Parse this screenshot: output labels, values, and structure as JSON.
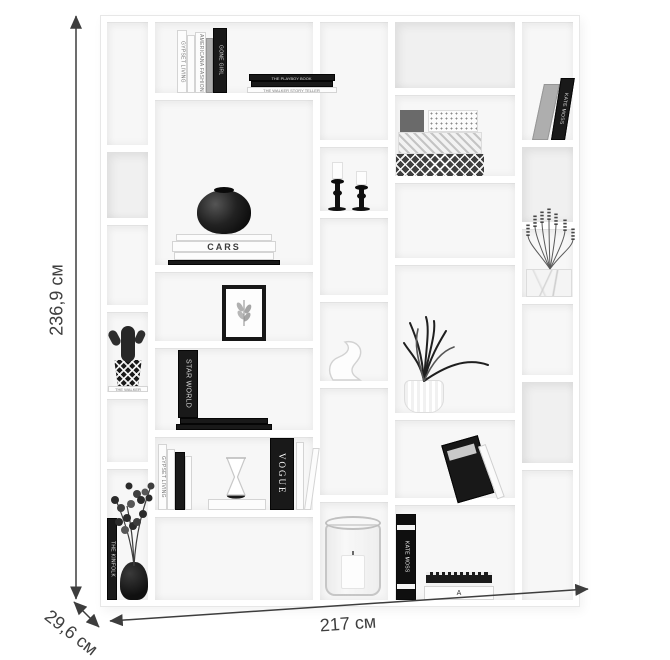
{
  "page": {
    "background": "#ffffff",
    "width": 670,
    "height": 660,
    "subject": "white modular bookshelf product image with dimension arrows"
  },
  "annotations": {
    "color": "#3d3d3d",
    "height": {
      "label": "236,9 см",
      "x": 57,
      "y": 300,
      "rotate": -90
    },
    "width": {
      "label": "217 см",
      "x": 348,
      "y": 624,
      "rotate": -4
    },
    "depth": {
      "label": "29,6 см",
      "x": 71,
      "y": 633,
      "rotate": 38
    },
    "lines": {
      "vertical": [
        76,
        16,
        76,
        599
      ],
      "horizontal": [
        110,
        621,
        588,
        589
      ],
      "diagonal": [
        74,
        602,
        99,
        627
      ]
    }
  },
  "shelf": {
    "frame": {
      "x": 100,
      "y": 15,
      "w": 480,
      "h": 592
    },
    "cells": [
      {
        "id": "A1",
        "x": 107,
        "y": 22,
        "w": 41,
        "h": 123
      },
      {
        "id": "A2",
        "x": 107,
        "y": 152,
        "w": 41,
        "h": 66,
        "shade": "dark"
      },
      {
        "id": "A3",
        "x": 107,
        "y": 225,
        "w": 41,
        "h": 80
      },
      {
        "id": "A4",
        "x": 107,
        "y": 312,
        "w": 41,
        "h": 80
      },
      {
        "id": "A5",
        "x": 107,
        "y": 399,
        "w": 41,
        "h": 63
      },
      {
        "id": "A6",
        "x": 107,
        "y": 469,
        "w": 41,
        "h": 131
      },
      {
        "id": "B1",
        "x": 155,
        "y": 22,
        "w": 158,
        "h": 71
      },
      {
        "id": "B2",
        "x": 155,
        "y": 100,
        "w": 158,
        "h": 165
      },
      {
        "id": "B3",
        "x": 155,
        "y": 272,
        "w": 158,
        "h": 69
      },
      {
        "id": "B4",
        "x": 155,
        "y": 348,
        "w": 158,
        "h": 82
      },
      {
        "id": "B5",
        "x": 155,
        "y": 437,
        "w": 158,
        "h": 73
      },
      {
        "id": "B6",
        "x": 155,
        "y": 517,
        "w": 158,
        "h": 83
      },
      {
        "id": "C1",
        "x": 320,
        "y": 22,
        "w": 68,
        "h": 118
      },
      {
        "id": "C2",
        "x": 320,
        "y": 147,
        "w": 68,
        "h": 64
      },
      {
        "id": "C3",
        "x": 320,
        "y": 218,
        "w": 68,
        "h": 77
      },
      {
        "id": "C4",
        "x": 320,
        "y": 302,
        "w": 68,
        "h": 79
      },
      {
        "id": "C5",
        "x": 320,
        "y": 388,
        "w": 68,
        "h": 107
      },
      {
        "id": "C6",
        "x": 320,
        "y": 502,
        "w": 68,
        "h": 98
      },
      {
        "id": "D1",
        "x": 395,
        "y": 22,
        "w": 120,
        "h": 66,
        "shade": "dark"
      },
      {
        "id": "D2",
        "x": 395,
        "y": 95,
        "w": 120,
        "h": 81
      },
      {
        "id": "D3",
        "x": 395,
        "y": 183,
        "w": 120,
        "h": 75
      },
      {
        "id": "D4",
        "x": 395,
        "y": 265,
        "w": 120,
        "h": 148
      },
      {
        "id": "D5",
        "x": 395,
        "y": 420,
        "w": 120,
        "h": 78
      },
      {
        "id": "D6",
        "x": 395,
        "y": 505,
        "w": 120,
        "h": 95
      },
      {
        "id": "E1",
        "x": 522,
        "y": 22,
        "w": 51,
        "h": 118
      },
      {
        "id": "E2",
        "x": 522,
        "y": 147,
        "w": 51,
        "h": 75,
        "shade": "dark"
      },
      {
        "id": "E3",
        "x": 522,
        "y": 229,
        "w": 51,
        "h": 68
      },
      {
        "id": "E4",
        "x": 522,
        "y": 304,
        "w": 51,
        "h": 71
      },
      {
        "id": "E5",
        "x": 522,
        "y": 382,
        "w": 51,
        "h": 81,
        "shade": "dark"
      },
      {
        "id": "E6",
        "x": 522,
        "y": 470,
        "w": 51,
        "h": 130
      }
    ],
    "items": [
      {
        "type": "book-row",
        "x": 177,
        "bottom": 93,
        "books": [
          {
            "w": 10,
            "h": 63,
            "c": "cw",
            "label": "GYPSET LIVING"
          },
          {
            "w": 8,
            "h": 58,
            "c": "cw",
            "label": ""
          },
          {
            "w": 11,
            "h": 61,
            "c": "cw",
            "label": "AMERICANA FASHION"
          },
          {
            "w": 7,
            "h": 55,
            "c": "cg",
            "label": ""
          },
          {
            "w": 14,
            "h": 65,
            "c": "cb",
            "label": "GONE GIRL"
          }
        ]
      },
      {
        "type": "flat-stack",
        "x": 244,
        "bottom": 93,
        "books": [
          {
            "w": 86,
            "h": 7,
            "c": "cb",
            "label": "THE PLAYBOY BOOK"
          },
          {
            "w": 82,
            "h": 6,
            "c": "cb",
            "label": ""
          },
          {
            "w": 90,
            "h": 6,
            "c": "cw",
            "label": "THE WALKER STORY TELLER"
          }
        ]
      },
      {
        "type": "vase-books",
        "x": 168,
        "bottom": 265,
        "label": "CARS"
      },
      {
        "type": "frame",
        "x": 222,
        "bottom": 341
      },
      {
        "type": "candles",
        "x": 326,
        "bottom": 211
      },
      {
        "type": "boxes",
        "x": 396,
        "bottom": 176
      },
      {
        "type": "leaning-books",
        "x": 530,
        "bottom": 140,
        "books": [
          {
            "w": 16,
            "h": 56,
            "c": "cg",
            "label": ""
          },
          {
            "w": 14,
            "h": 62,
            "c": "cb",
            "label": "KATE MOSS"
          }
        ]
      },
      {
        "type": "cactus",
        "x": 108,
        "bottom": 392,
        "book_label": "THE WALKER STORY TELLER"
      },
      {
        "type": "eucalyptus",
        "x": 107,
        "bottom": 600,
        "book_label": "THE KINFOLK"
      },
      {
        "type": "standing-flat",
        "x": 176,
        "bottom": 430,
        "label": "STAR WORLD"
      },
      {
        "type": "hourglass-group",
        "x": 158,
        "bottom": 510,
        "left_label": "GYPSET LIVING",
        "right_label": "VOGUE"
      },
      {
        "type": "swan",
        "x": 325,
        "bottom": 381
      },
      {
        "type": "grass-plant",
        "x": 396,
        "bottom": 413
      },
      {
        "type": "lavender",
        "x": 522,
        "bottom": 297
      },
      {
        "type": "leaning-black-book",
        "x": 455,
        "bottom": 498
      },
      {
        "type": "glass-candle",
        "x": 324,
        "bottom": 596
      },
      {
        "type": "notebook-group",
        "x": 396,
        "bottom": 600,
        "book_label": "KATE MOSS",
        "note_label": "A"
      }
    ]
  }
}
